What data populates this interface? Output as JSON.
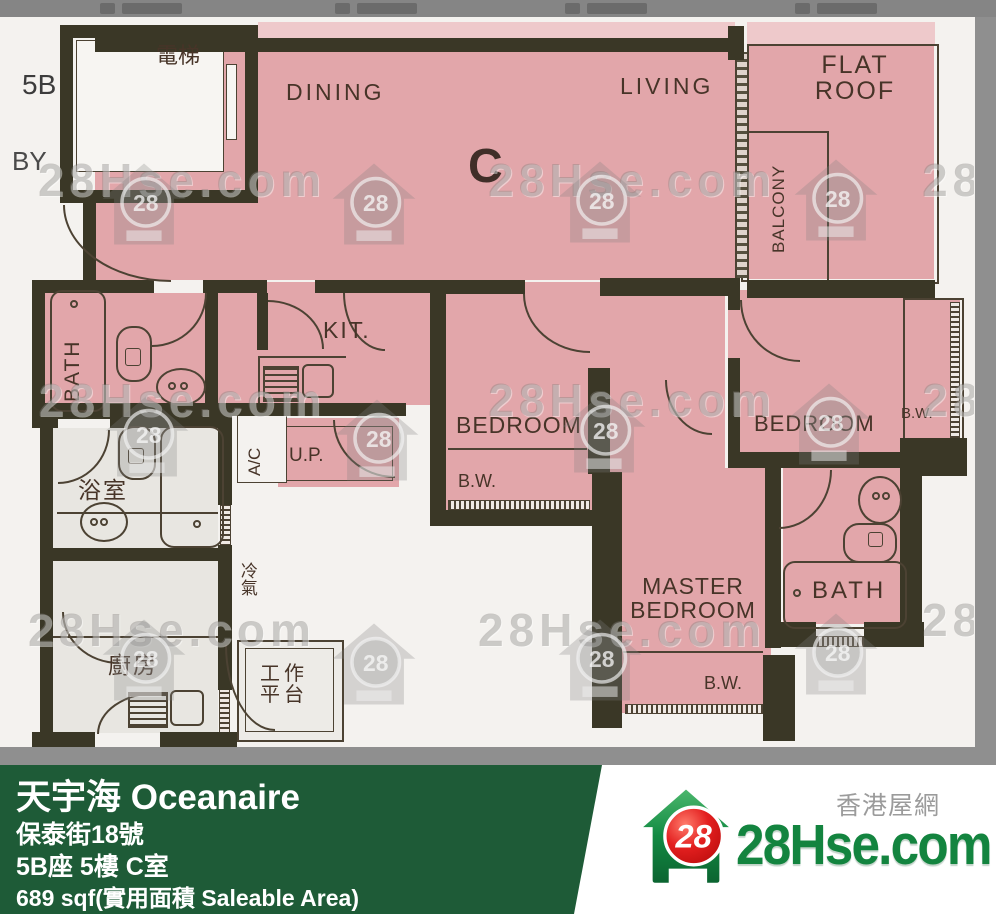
{
  "plan": {
    "rooms": {
      "block": "5B",
      "lobby": "BY",
      "lift": "電梯",
      "dining": "DINING",
      "living": "LIVING",
      "unit": "C",
      "flat_roof_line1": "FLAT",
      "flat_roof_line2": "ROOF",
      "balcony": "BALCONY",
      "kitchen": "KIT.",
      "bath": "BATH",
      "bedroom": "BEDROOM",
      "master_line1": "MASTER",
      "master_line2": "BEDROOM",
      "bay_window": "B.W.",
      "utility": "U.P.",
      "ac_platform": "A/C",
      "aircon": "冷氣",
      "bathroom_cn": "浴室",
      "kitchen_cn": "廚房",
      "work_line1": "工作",
      "work_line2": "平台"
    },
    "colors": {
      "room_pink": "#e2a6aa",
      "wall_dark": "#3a3726",
      "other_unit_grey": "#e8e6e1"
    }
  },
  "watermark": {
    "text": "28Hse.com",
    "badge": "28"
  },
  "footer": {
    "title": "天宇海 Oceanaire",
    "address": "保泰街18號",
    "unit": "5B座 5樓 C室",
    "area": "689 sqf(實用面積 Saleable Area)",
    "bar_color": "#1e5b37",
    "logo": {
      "badge": "28",
      "site": "28Hse.com",
      "site_cn": "香港屋網"
    }
  }
}
